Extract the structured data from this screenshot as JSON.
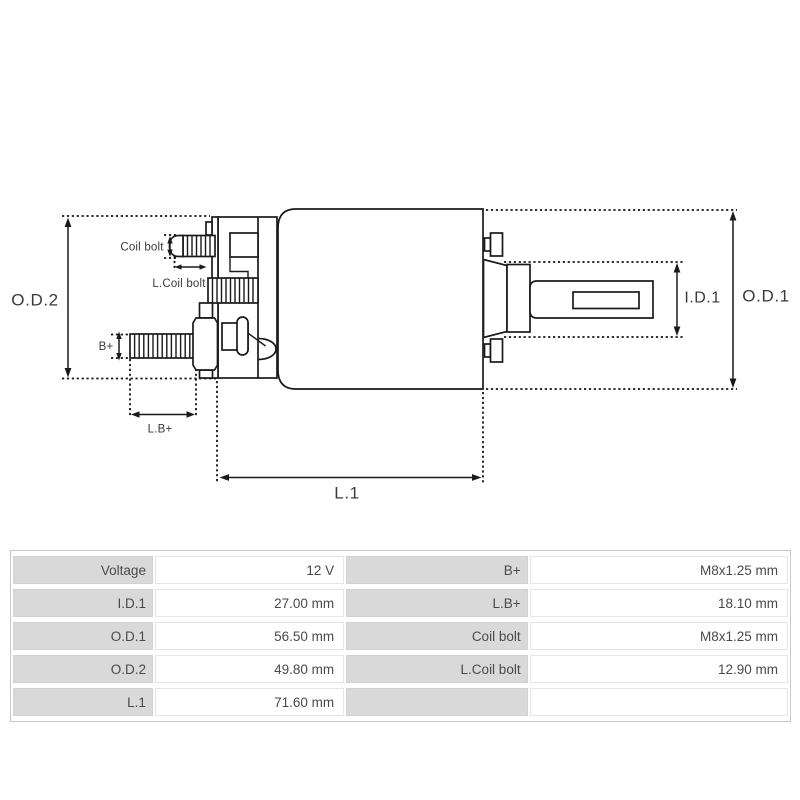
{
  "diagram": {
    "type": "technical-drawing",
    "subject": "starter-solenoid-side-view",
    "line_color": "#1a1a1a",
    "label_color": "#3a3a3a",
    "labels": {
      "od2": "O.D.2",
      "od1": "O.D.1",
      "id1": "I.D.1",
      "l1": "L.1",
      "b_plus": "B+",
      "lb_plus": "L.B+",
      "coil_bolt": "Coil bolt",
      "l_coil_bolt": "L.Coil bolt"
    }
  },
  "table": {
    "label_bg": "#d9d9d9",
    "value_bg": "#ffffff",
    "text_color": "#4a4a4a",
    "rows": [
      [
        "Voltage",
        "12 V",
        "B+",
        "M8x1.25 mm"
      ],
      [
        "I.D.1",
        "27.00 mm",
        "L.B+",
        "18.10 mm"
      ],
      [
        "O.D.1",
        "56.50 mm",
        "Coil bolt",
        "M8x1.25 mm"
      ],
      [
        "O.D.2",
        "49.80 mm",
        "L.Coil bolt",
        "12.90 mm"
      ],
      [
        "L.1",
        "71.60 mm",
        "",
        ""
      ]
    ]
  }
}
